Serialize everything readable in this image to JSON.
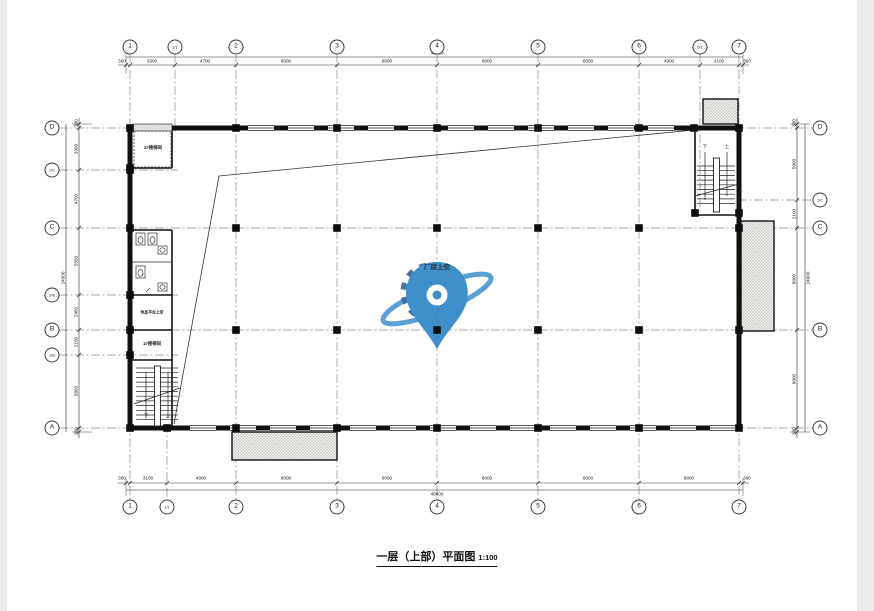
{
  "drawing": {
    "title": "一层（上部）平面图",
    "scale": "1:100",
    "void_label": "厂房上空",
    "rooms": {
      "stair2": "2#楼梯间",
      "landing": "休息平台上空",
      "stair1": "1#楼梯间",
      "up": "上",
      "down": "下"
    }
  },
  "grid": {
    "top_axes": [
      "1",
      "1/1",
      "2",
      "3",
      "4",
      "5",
      "6",
      "6/1",
      "7"
    ],
    "bottom_axes": [
      "1",
      "1/1",
      "2",
      "3",
      "4",
      "5",
      "6",
      "7"
    ],
    "left_axes": [
      "D",
      "1/C",
      "C",
      "2/B",
      "B",
      "1/B",
      "A"
    ],
    "right_axes": [
      "D",
      "1/C",
      "C",
      "B",
      "A"
    ]
  },
  "dimensions": {
    "top": [
      "300",
      "3300",
      "4700",
      "8000",
      "8000",
      "8000",
      "8000",
      "4900",
      "3100",
      "300"
    ],
    "top_overall": "48000",
    "bottom": [
      "300",
      "3100",
      "4900",
      "8000",
      "8000",
      "8000",
      "8000",
      "8000",
      "300"
    ],
    "bottom_overall": "48000",
    "left": [
      "300",
      "3300",
      "4700",
      "5550",
      "2450",
      "2150",
      "5850",
      "300"
    ],
    "left_overall": "24000",
    "right": [
      "300",
      "5900",
      "2100",
      "8000",
      "8000",
      "300"
    ],
    "right_overall": "24000"
  },
  "colors": {
    "line": "#1a1a1a",
    "axis": "#8a8a8a",
    "watermark_blue": "#2e86c6",
    "watermark_dark": "#2b5f94",
    "hatch_fill": "#efefec"
  }
}
